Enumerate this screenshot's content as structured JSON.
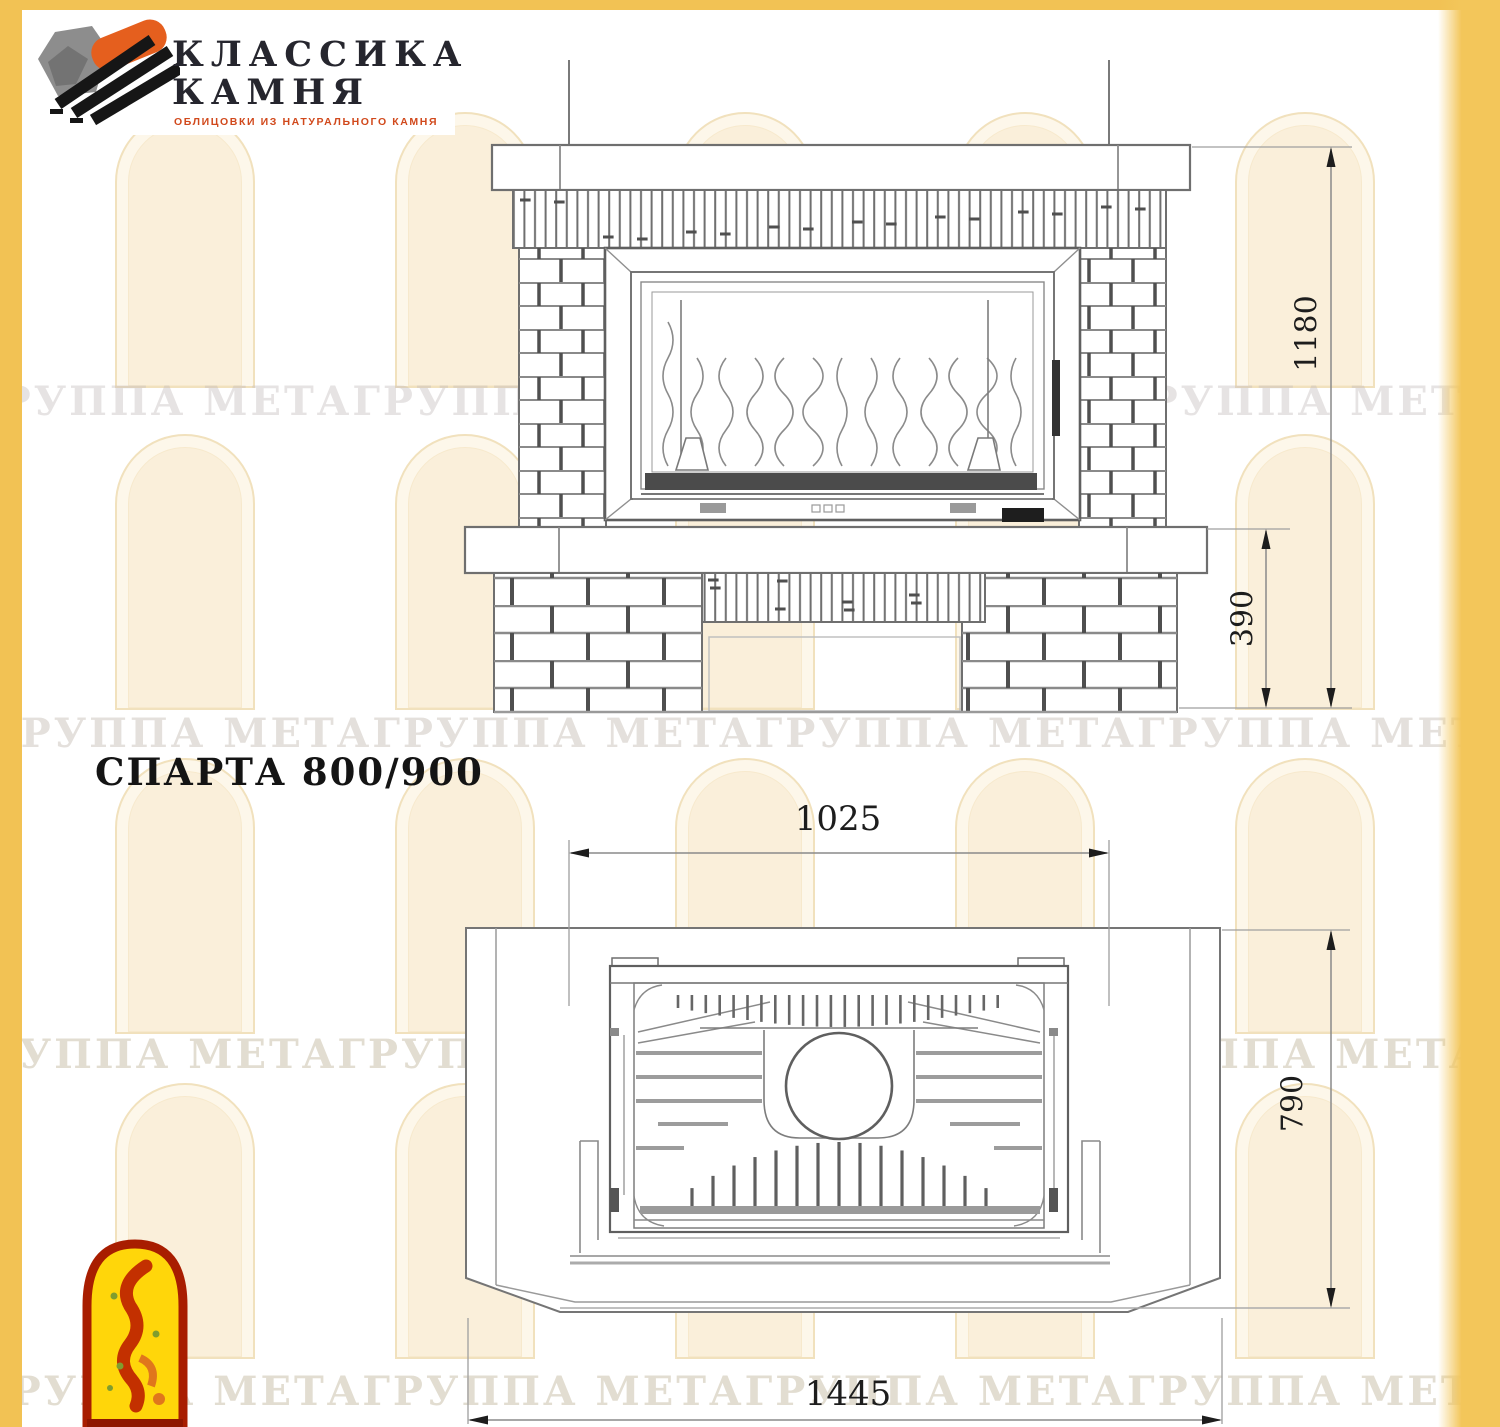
{
  "colors": {
    "frame_yellow": "#f2c254",
    "drawing_line": "#777777",
    "joint_dark": "#4f4f4f",
    "dim_text": "#1d1d1d",
    "logo_text": "#26262e",
    "logo_accent_orange": "#e55f1e",
    "tagline_orange": "#d1491c",
    "watermark_tan": "#b6aa8c",
    "jester_yellow": "#ffd60a",
    "jester_red": "#a81d00"
  },
  "logo": {
    "title_line1": "КЛАССИКА",
    "title_line2": "КАМНЯ",
    "tagline": "ОБЛИЦОВКИ ИЗ НАТУРАЛЬНОГО КАМНЯ"
  },
  "title": "СПАРТА 800/900",
  "watermark_text": "ГРУППА МЕТАГРУППА МЕТАГРУППА МЕТАГРУППА МЕТАГРУППА МЕТАГРУППА МЕТА",
  "front_view": {
    "height": "1180",
    "base_height": "390"
  },
  "plan_view": {
    "top_width": "1025",
    "depth": "790",
    "total_width": "1445"
  }
}
